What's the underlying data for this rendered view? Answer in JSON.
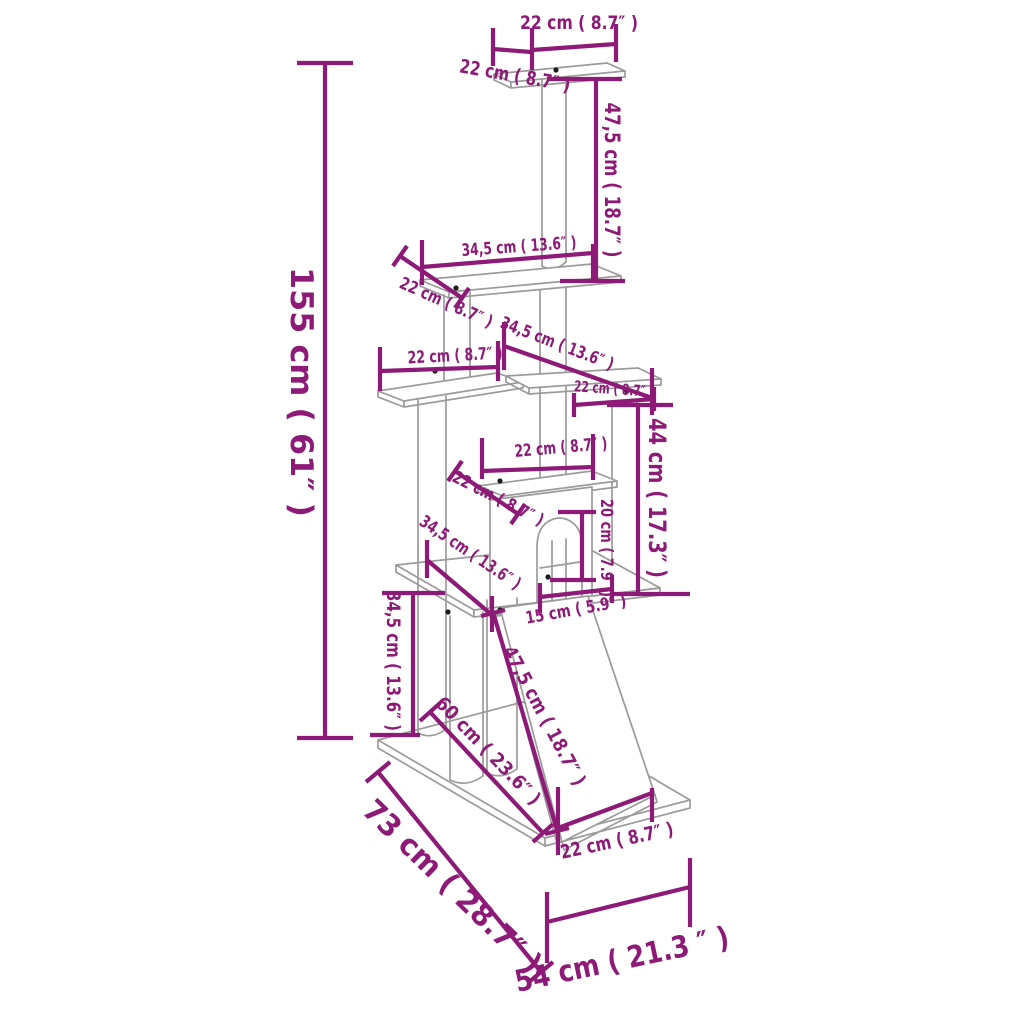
{
  "diagram": {
    "kind": "product-dimension-diagram",
    "subject": "cat-tree-with-scratching-posts-dimension-drawing"
  },
  "colors": {
    "dimension": "#8E1A78",
    "structure": "#9B9B9B",
    "background": "#FFFFFF"
  },
  "dimensions": [
    {
      "id": "overall-height",
      "label": "155 cm ( 61″ )"
    },
    {
      "id": "top-platform-width",
      "label": "22 cm ( 8.7″ )"
    },
    {
      "id": "top-platform-depth",
      "label": "22 cm ( 8.7″ )"
    },
    {
      "id": "top-post-height",
      "label": "47,5 cm ( 18.7″ )"
    },
    {
      "id": "second-platform-width",
      "label": "34,5 cm ( 13.6″ )"
    },
    {
      "id": "second-platform-depth",
      "label": "22 cm ( 8.7″ )"
    },
    {
      "id": "left-platform-width",
      "label": "22 cm ( 8.7″ )"
    },
    {
      "id": "right-platform-length",
      "label": "34,5 cm ( 13.6″ )"
    },
    {
      "id": "right-platform-depth",
      "label": "22 cm ( 8.7″ )"
    },
    {
      "id": "mid-level-height",
      "label": "44 cm ( 17.3″ )"
    },
    {
      "id": "house-roof-width",
      "label": "22 cm ( 8.7″ )"
    },
    {
      "id": "house-roof-depth",
      "label": "22 cm ( 8.7″ )"
    },
    {
      "id": "main-platform-depth",
      "label": "34,5 cm ( 13.6″ )"
    },
    {
      "id": "door-height",
      "label": "20 cm ( 7.9″ )"
    },
    {
      "id": "door-width",
      "label": "15 cm ( 5.9″ )"
    },
    {
      "id": "base-clearance-height",
      "label": "34,5 cm ( 13.6″ )"
    },
    {
      "id": "ramp-span",
      "label": "60 cm ( 23.6″ )"
    },
    {
      "id": "ramp-length",
      "label": "47,5 cm ( 18.7″ )"
    },
    {
      "id": "ramp-width",
      "label": "22 cm ( 8.7″ )"
    },
    {
      "id": "base-depth",
      "label": "73 cm ( 28.7″ )"
    },
    {
      "id": "base-width",
      "label": "54 cm ( 21.3 ″ )"
    }
  ]
}
